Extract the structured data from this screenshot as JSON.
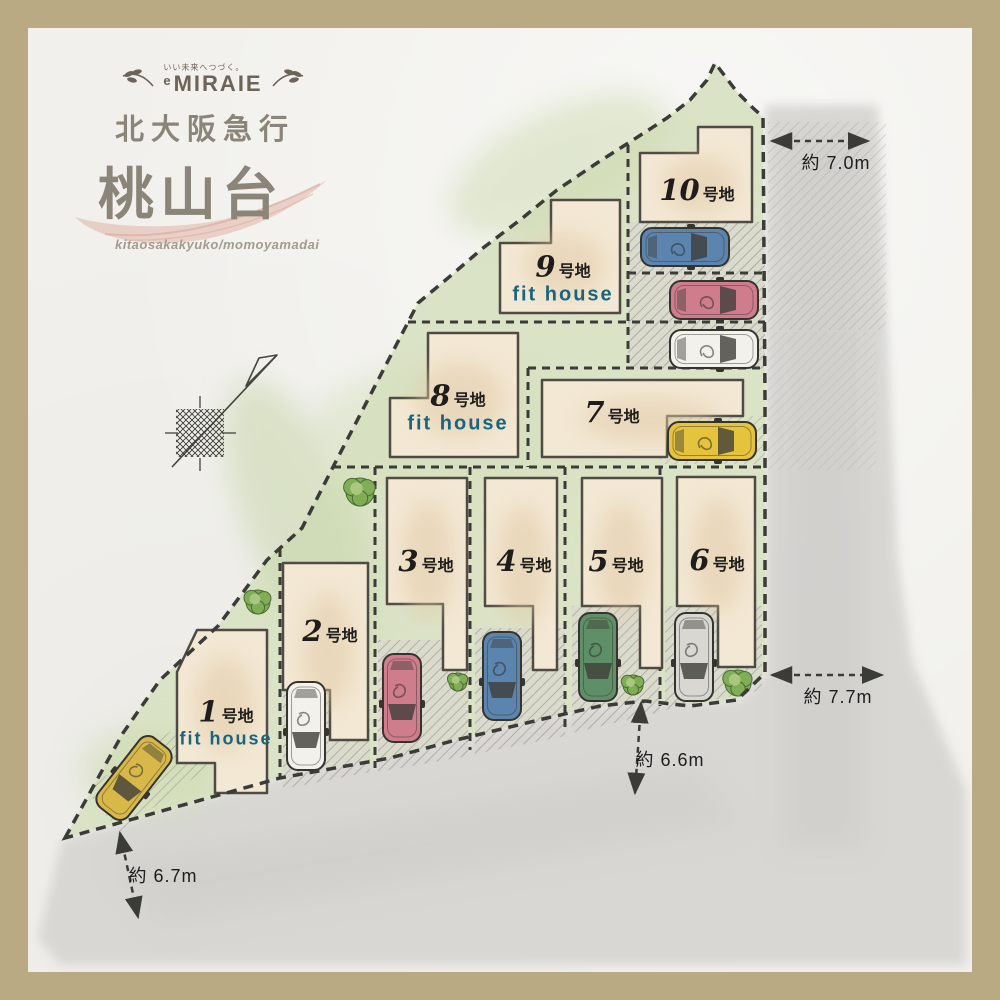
{
  "brand": {
    "tagline": "いい未来へつづく。",
    "logo_prefix": "e",
    "logo": "MIRAIE",
    "line_name": "北大阪急行",
    "area_name": "桃山台",
    "romaji": "kitaosakakyuko/momoyamadai"
  },
  "lots": [
    {
      "number": "1",
      "suffix": "号地",
      "note": "fit house"
    },
    {
      "number": "2",
      "suffix": "号地"
    },
    {
      "number": "3",
      "suffix": "号地"
    },
    {
      "number": "4",
      "suffix": "号地"
    },
    {
      "number": "5",
      "suffix": "号地"
    },
    {
      "number": "6",
      "suffix": "号地"
    },
    {
      "number": "7",
      "suffix": "号地"
    },
    {
      "number": "8",
      "suffix": "号地",
      "note": "fit house"
    },
    {
      "number": "9",
      "suffix": "号地",
      "note": "fit house"
    },
    {
      "number": "10",
      "suffix": "号地"
    }
  ],
  "dimensions": {
    "top_right": "約 7.0m",
    "right": "約 7.7m",
    "middle": "約 6.6m",
    "bottom_left": "約 6.7m"
  },
  "colors": {
    "frame": "#b9aa83",
    "paper": "#f1f0ec",
    "site_green": "#dbe3c7",
    "road_gray": "#d6d5d1",
    "building_fill": "#f3e8d4",
    "building_edge": "#4e4a44",
    "dashed_line": "#3b3b37",
    "fit_house_text": "#17657f",
    "brand_text": "#8b8478",
    "swoosh_pink": "#e3bdb2"
  },
  "cars": [
    {
      "lot": "10",
      "color": "#5b84ae",
      "x": 685,
      "y": 247,
      "rotate": -90
    },
    {
      "lot": "9-space",
      "color": "#cf7d8c",
      "x": 714,
      "y": 300,
      "rotate": -90
    },
    {
      "lot": "8-space",
      "color": "#f2f1ec",
      "x": 714,
      "y": 349,
      "rotate": -90
    },
    {
      "lot": "7",
      "color": "#e5c33c",
      "x": 712,
      "y": 441,
      "rotate": -90
    },
    {
      "lot": "6",
      "color": "#d8d7d2",
      "x": 694,
      "y": 657,
      "rotate": 0
    },
    {
      "lot": "5",
      "color": "#5f8f66",
      "x": 598,
      "y": 657,
      "rotate": 0
    },
    {
      "lot": "4",
      "color": "#5b84ae",
      "x": 502,
      "y": 676,
      "rotate": 0
    },
    {
      "lot": "3",
      "color": "#cf7d8c",
      "x": 402,
      "y": 698,
      "rotate": 0
    },
    {
      "lot": "2",
      "color": "#f2f1ec",
      "x": 306,
      "y": 726,
      "rotate": 0
    },
    {
      "lot": "1",
      "color": "#d9b84a",
      "x": 134,
      "y": 778,
      "rotate": 38
    }
  ],
  "bushes": [
    {
      "x": 360,
      "y": 492,
      "r": 14
    },
    {
      "x": 258,
      "y": 602,
      "r": 12
    },
    {
      "x": 458,
      "y": 682,
      "r": 9
    },
    {
      "x": 633,
      "y": 685,
      "r": 10
    },
    {
      "x": 738,
      "y": 683,
      "r": 13
    }
  ]
}
